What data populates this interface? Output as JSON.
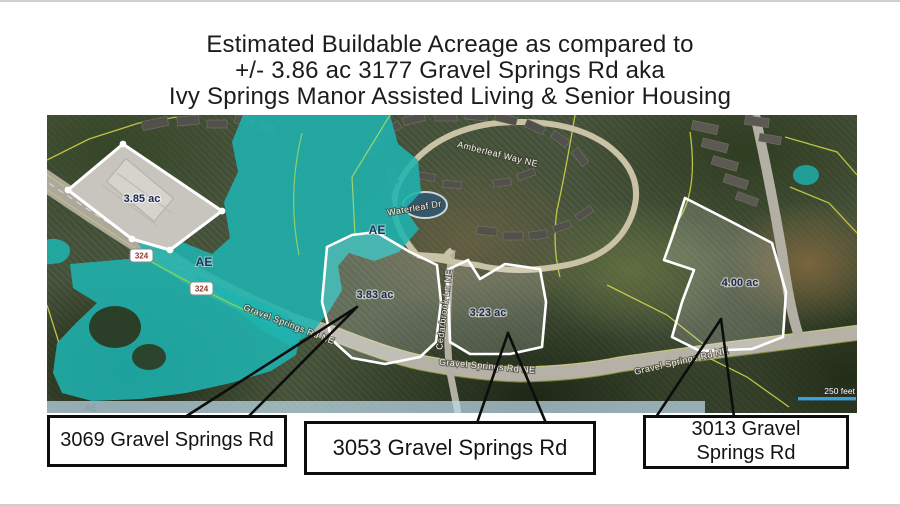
{
  "title": {
    "line1": "Estimated Buildable Acreage as compared to",
    "line2": "+/- 3.86 ac 3177 Gravel Springs Rd aka",
    "line3": "Ivy Springs Manor Assisted Living & Senior Housing"
  },
  "map": {
    "acreage_labels": [
      {
        "value": "3.85 ac"
      },
      {
        "value": "3.83 ac"
      },
      {
        "value": "3.23 ac"
      },
      {
        "value": "4.00 ac"
      }
    ],
    "flood_zone_labels": {
      "left": "AE",
      "pond": "AE",
      "band": "AE"
    },
    "route_shields": [
      {
        "number": "324"
      },
      {
        "number": "324"
      }
    ],
    "street_labels": {
      "gravel_springs_left": "Gravel Springs Rd NE",
      "gravel_springs_center": "Gravel Springs Rd NE",
      "gravel_springs_right": "Gravel Springs Rd NE",
      "amberleaf": "Amberleaf Way NE",
      "waterleaf": "Waterleaf Dr",
      "cedarbrook": "Cedarbrook Ln NE"
    },
    "scale_label": "250 feet",
    "colors": {
      "flood_zone": "#1fb3af",
      "parcel_lines": "#dde14a",
      "scale_bar": "#3aa0dc"
    }
  },
  "callouts": [
    {
      "label": "3069 Gravel Springs Rd"
    },
    {
      "label": "3053 Gravel Springs Rd"
    },
    {
      "label": "3013 Gravel Springs Rd"
    }
  ]
}
